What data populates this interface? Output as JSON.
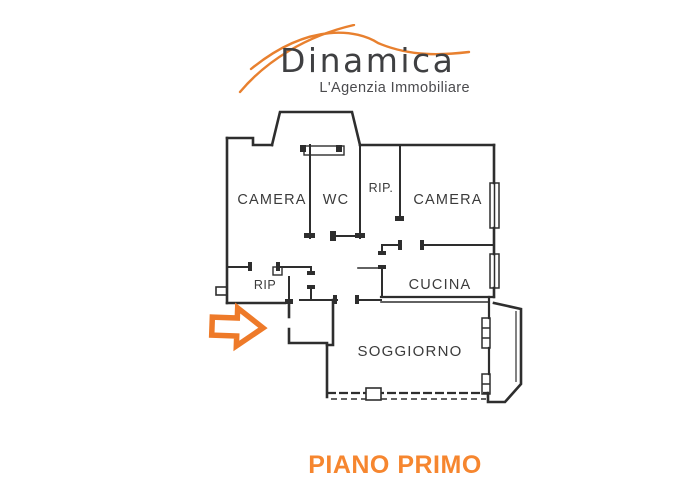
{
  "logo": {
    "brand": "Dinamica",
    "tagline": "L'Agenzia Immobiliare"
  },
  "floor_label": "PIANO PRIMO",
  "plan": {
    "rooms": [
      {
        "label": "CAMERA"
      },
      {
        "label": "WC"
      },
      {
        "label": "RIP."
      },
      {
        "label": "CAMERA"
      },
      {
        "label": "RIP"
      },
      {
        "label": "CUCINA"
      },
      {
        "label": "SOGGIORNO"
      }
    ]
  },
  "icons": {
    "entrance_arrow": "right-block-arrow",
    "logo_swoosh": "roof-swoosh"
  },
  "colors": {
    "accent_orange": "#EE7A29",
    "floor_label_orange": "#F6862F",
    "logo_text": "#3F4042",
    "tagline_text": "#4B4B4E",
    "plan_line": "#2E2E2E"
  }
}
